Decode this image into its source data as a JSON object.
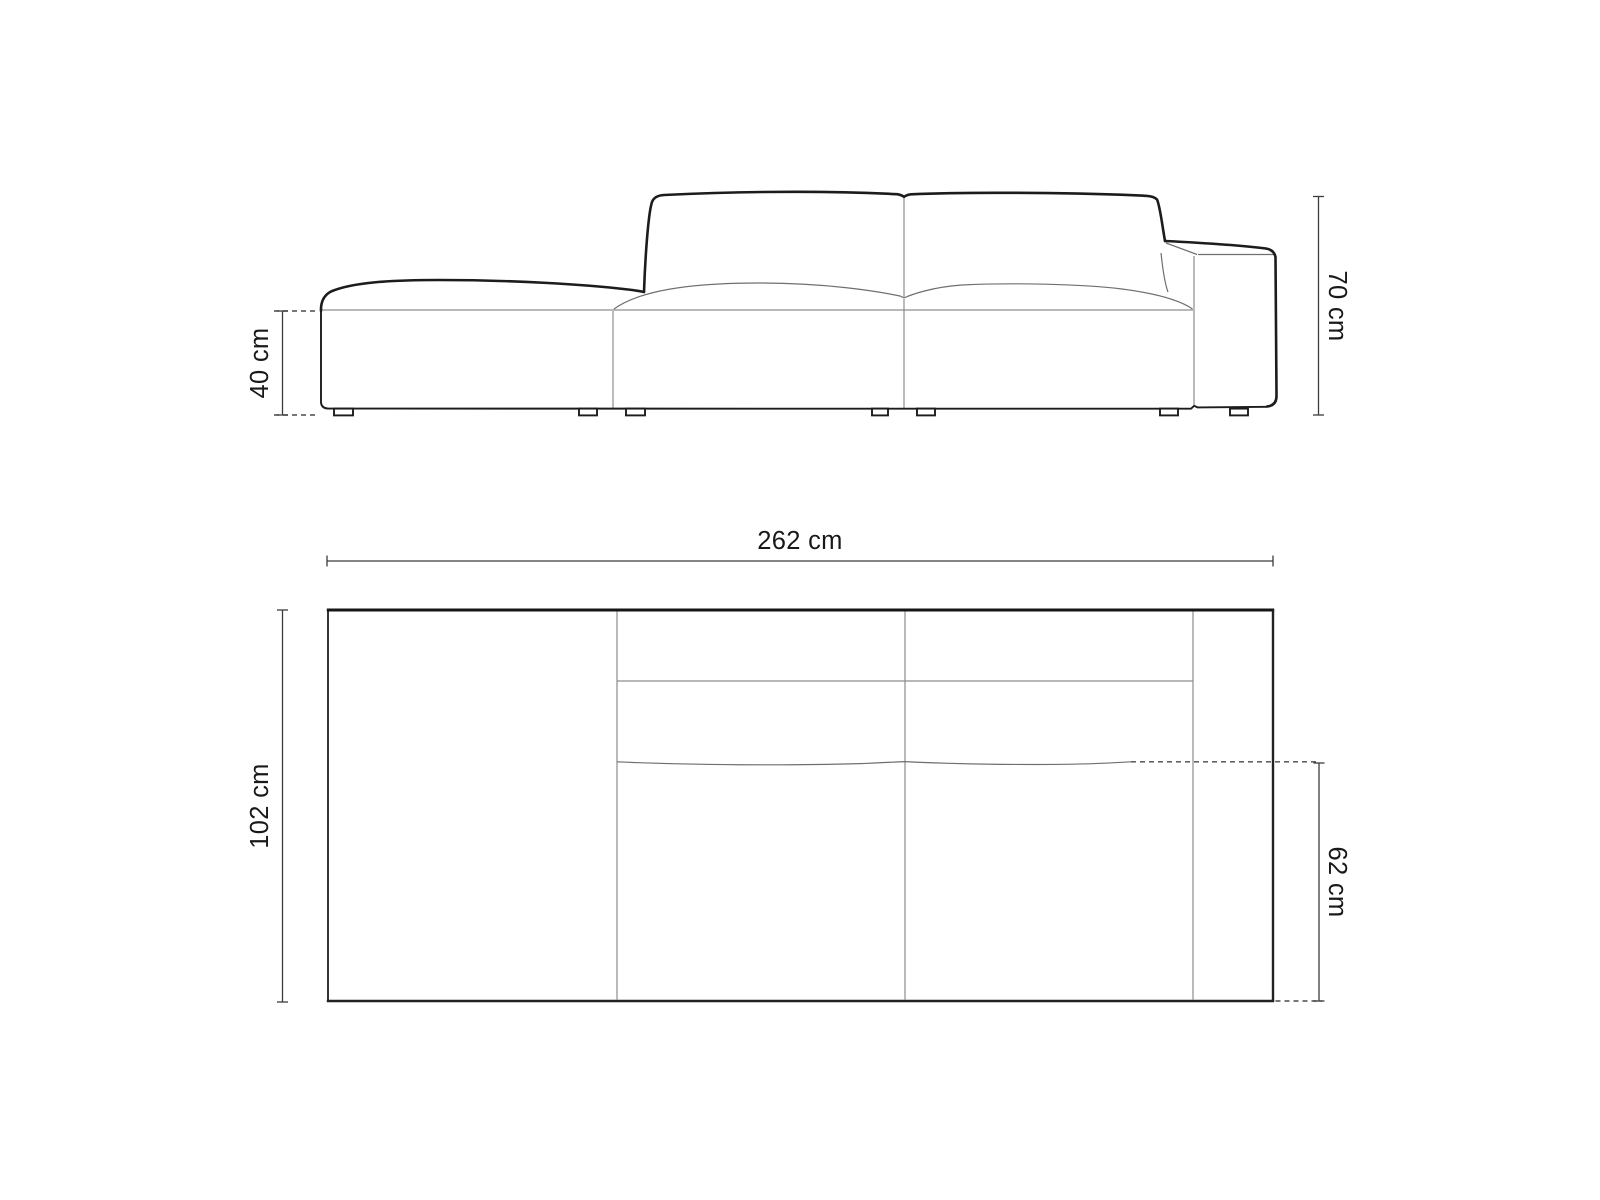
{
  "document": {
    "background_color": "#ffffff",
    "drawing_type": "sofa-dimension-diagram",
    "subject": "Modular sofa with open chaise end (left) and armrest (right), front elevation and top plan views"
  },
  "views": {
    "front_elevation": {
      "name": "front-elevation",
      "seat_height": "40 cm",
      "overall_height": "70 cm"
    },
    "top_plan": {
      "name": "top-plan",
      "overall_width": "262 cm",
      "overall_depth": "102 cm",
      "seat_depth": "62 cm"
    }
  },
  "style": {
    "outline_color": "#1c1c1c",
    "seam_color": "#8d8d8d",
    "dimension_line_color": "#3c3c3c",
    "dashed_line_color": "#4a4a4a",
    "text_color": "#191919"
  }
}
